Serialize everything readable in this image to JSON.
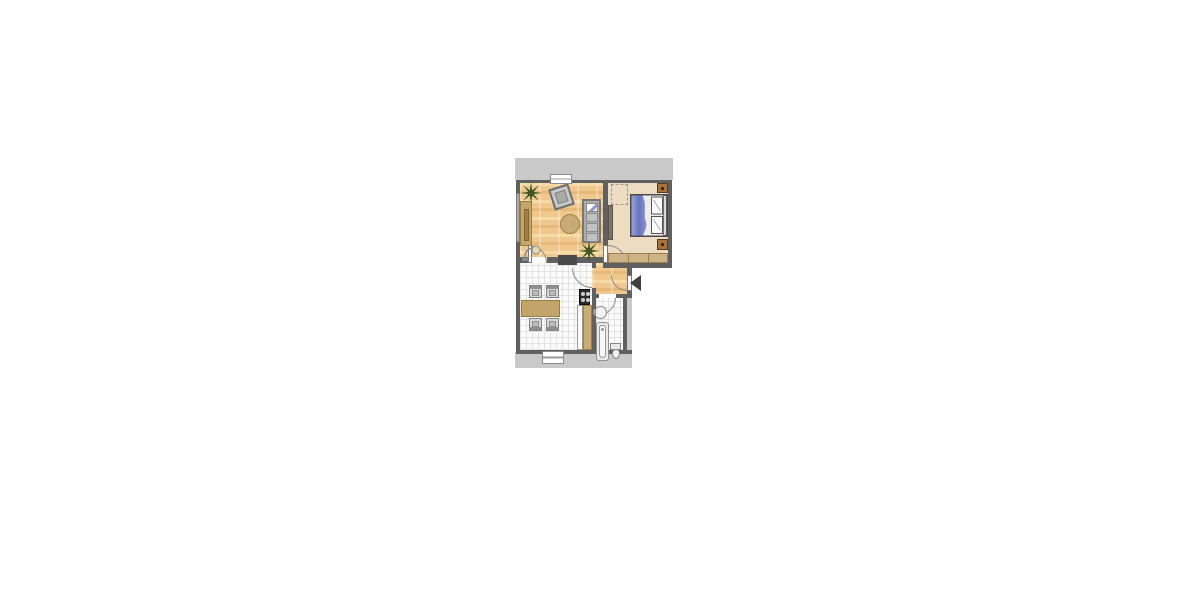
{
  "colors": {
    "exterior_band": "#c9c9c9",
    "wall": "#606060",
    "wood_base": "#f0c88e",
    "wood_light": "#f7dba6",
    "wood_dark": "#e7b878",
    "bedroom_floor": "#eddcc1",
    "tile": "#fbfbfb",
    "tile_line": "#e2e2e2",
    "tan": "#c3a46a",
    "tan_dark": "#97803f",
    "gray_furniture": "#bdbdbd",
    "nightstand": "#a4713b",
    "bed_blue": "#7b85c7",
    "plant_green": "#2a5423",
    "arrow": "#3f3f3f",
    "door_arc": "#8a8a8a"
  },
  "floorplan": {
    "rooms": [
      {
        "name": "living-room",
        "floor": "wood",
        "items": [
          "palm-plant",
          "tilted-armchair",
          "sideboard",
          "round-table",
          "sofa-with-blanket",
          "palm-plant",
          "floor-lamp",
          "top-window",
          "left-window"
        ]
      },
      {
        "name": "bedroom",
        "floor": "beige",
        "items": [
          "dashed-wardrobe-outline",
          "double-bed-blue-duvet",
          "nightstand",
          "nightstand",
          "bench",
          "radiator"
        ]
      },
      {
        "name": "kitchen-dining",
        "floor": "tile",
        "items": [
          "dining-table",
          "chair",
          "chair",
          "chair",
          "chair",
          "stove",
          "counter",
          "cabinet",
          "bottom-window"
        ]
      },
      {
        "name": "hallway",
        "floor": "wood",
        "items": [
          "entrance-door",
          "entrance-arrow"
        ]
      },
      {
        "name": "bathroom",
        "floor": "tile",
        "items": [
          "sink",
          "bathtub",
          "toilet"
        ]
      }
    ],
    "entrance": {
      "side": "right",
      "indicator": "black-left-pointing-arrow"
    }
  }
}
